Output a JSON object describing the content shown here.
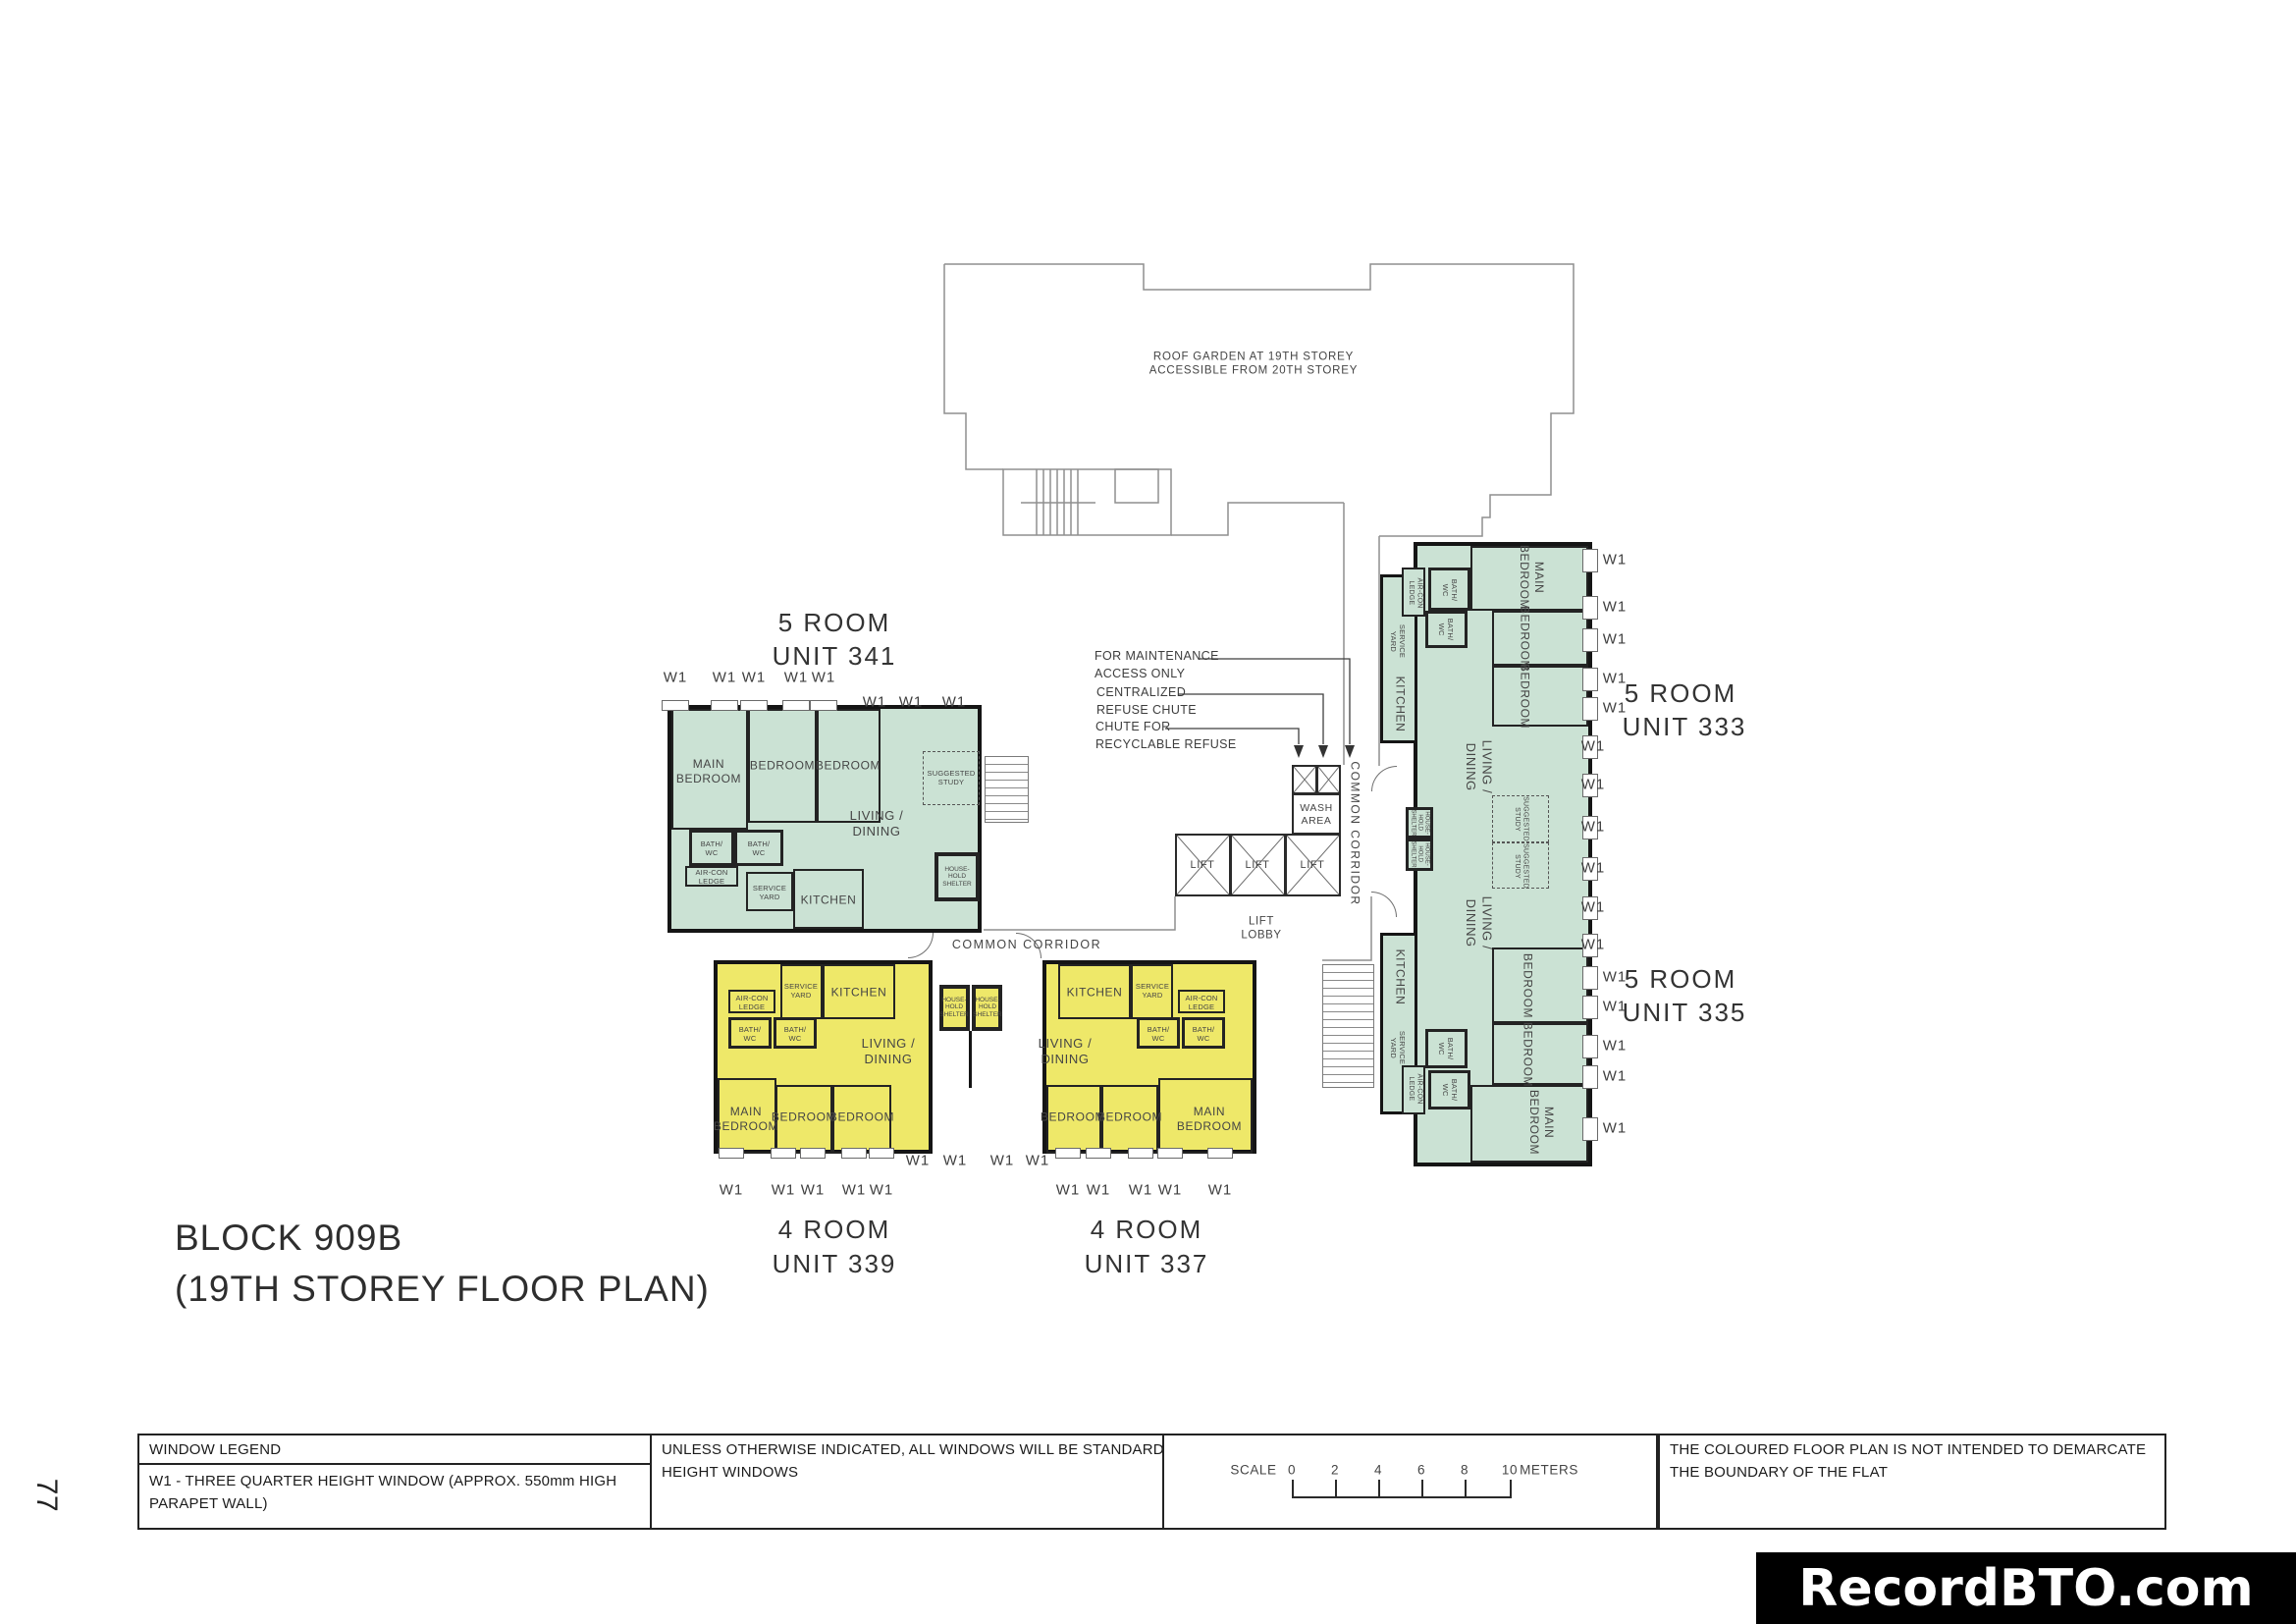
{
  "page": {
    "number": "77",
    "watermark": "RecordBTO.com"
  },
  "title": {
    "line1": "BLOCK 909B",
    "line2": "(19TH STOREY FLOOR PLAN)"
  },
  "plan": {
    "roof_garden_note": "ROOF GARDEN AT 19TH STOREY\nACCESSIBLE FROM 20TH STOREY",
    "annotations": {
      "maintenance": "FOR MAINTENANCE\nACCESS ONLY",
      "centralized_refuse": "CENTRALIZED\nREFUSE CHUTE",
      "recyclable_refuse": "CHUTE FOR\nRECYCLABLE REFUSE"
    },
    "labels": {
      "lift": "LIFT",
      "lift_lobby": "LIFT\nLOBBY",
      "wash_area": "WASH\nAREA",
      "common_corridor": "COMMON CORRIDOR",
      "window": "W1"
    },
    "rooms": {
      "main_bedroom": "MAIN\nBEDROOM",
      "bedroom": "BEDROOM",
      "living_dining": "LIVING /\nDINING",
      "kitchen": "KITCHEN",
      "bath_wc": "BATH/\nWC",
      "service_yard": "SERVICE\nYARD",
      "aircon_ledge": "AIR-CON\nLEDGE",
      "household_shelter": "HOUSE-\nHOLD\nSHELTER",
      "suggested_study": "SUGGESTED\nSTUDY"
    },
    "units": {
      "u341": {
        "type": "5 ROOM",
        "number": "UNIT 341"
      },
      "u333": {
        "type": "5 ROOM",
        "number": "UNIT 333"
      },
      "u335": {
        "type": "5 ROOM",
        "number": "UNIT 335"
      },
      "u339": {
        "type": "4 ROOM",
        "number": "UNIT 339"
      },
      "u337": {
        "type": "4 ROOM",
        "number": "UNIT 337"
      }
    },
    "colors": {
      "five_room_fill": "#cbe2d4",
      "four_room_fill": "#eee869"
    }
  },
  "legend": {
    "window_legend_title": "WINDOW LEGEND",
    "w1_description": "W1 - THREE QUARTER HEIGHT WINDOW (APPROX. 550mm HIGH\nPARAPET WALL)",
    "windows_note": "UNLESS OTHERWISE INDICATED, ALL WINDOWS WILL BE STANDARD\nHEIGHT WINDOWS",
    "scale": {
      "label": "SCALE",
      "ticks": [
        "0",
        "2",
        "4",
        "6",
        "8",
        "10"
      ],
      "unit": "METERS"
    },
    "boundary_note": "THE COLOURED FLOOR PLAN IS NOT INTENDED TO DEMARCATE\nTHE BOUNDARY OF THE FLAT"
  }
}
